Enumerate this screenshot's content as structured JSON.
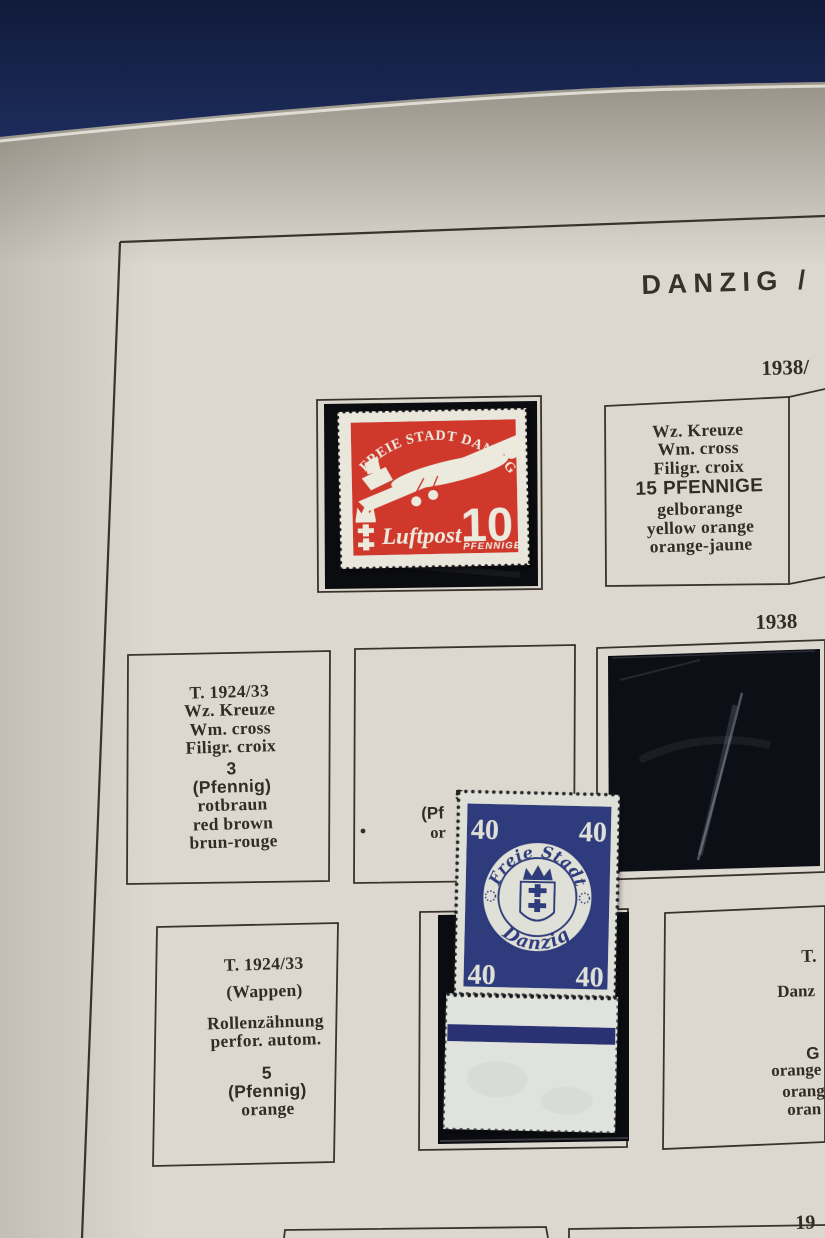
{
  "page": {
    "title": "DANZIG /",
    "years": {
      "top": "1938/",
      "middle": "1938",
      "bottom": "19"
    }
  },
  "labels": {
    "top_right": {
      "lines": [
        "Wz. Kreuze",
        "Wm. cross",
        "Filigr. croix",
        "15 PFENNIGE",
        "gelborange",
        "yellow orange",
        "orange-jaune"
      ]
    },
    "mid_left": {
      "lines": [
        "T. 1924/33",
        "Wz. Kreuze",
        "Wm. cross",
        "Filigr. croix",
        "3",
        "(Pfennig)",
        "rotbraun",
        "red brown",
        "brun-rouge"
      ]
    },
    "bottom_left": {
      "lines": [
        "T. 1924/33",
        "(Wappen)",
        "Rollenzähnung",
        "perfor. autom.",
        "5",
        "(Pfennig)",
        "orange"
      ]
    },
    "bottom_right_clipped": {
      "lines": [
        "T.",
        "Danz",
        "G",
        "orange",
        "orang",
        "oran"
      ]
    },
    "mid_center_clipped": {
      "fragment_top": "5",
      "fragment_mid": "(Pf",
      "fragment_low": "or"
    }
  },
  "stamps": {
    "airmail_10": {
      "arc_text": "FREIE STADT DANZIG",
      "script_text": "Luftpost",
      "value": "10",
      "unit": "PFENNIGE"
    },
    "arms_40": {
      "ring_top": "Freie Stadt",
      "ring_bottom": "Danzig",
      "corner_value": "40"
    }
  },
  "colors": {
    "album_cover": "#15234c",
    "page": "#dcd8d0",
    "ink": "#332c24",
    "stamp_red": "#cf392b",
    "stamp_cream": "#e9e6db",
    "stamp_blue": "#2d3a7c",
    "stamp_paper": "#dfe0d8",
    "mount_black": "#0b0c10"
  }
}
